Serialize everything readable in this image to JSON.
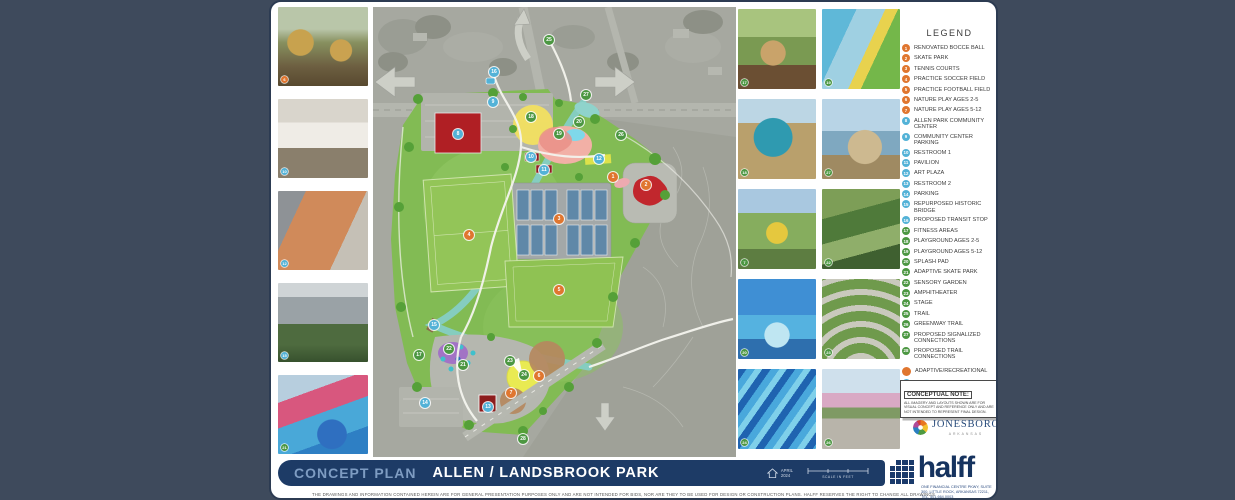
{
  "colors": {
    "orange": "#e0762f",
    "blue": "#53b2d7",
    "green": "#4c9742",
    "navy": "#1d3b66"
  },
  "legend": {
    "title": "LEGEND",
    "items": [
      {
        "n": 1,
        "c": "orange",
        "label": "RENOVATED BOCCE BALL"
      },
      {
        "n": 2,
        "c": "orange",
        "label": "SKATE PARK"
      },
      {
        "n": 3,
        "c": "orange",
        "label": "TENNIS COURTS"
      },
      {
        "n": 4,
        "c": "orange",
        "label": "PRACTICE SOCCER FIELD"
      },
      {
        "n": 5,
        "c": "orange",
        "label": "PRACTICE FOOTBALL FIELD"
      },
      {
        "n": 6,
        "c": "orange",
        "label": "NATURE PLAY AGES 2-5"
      },
      {
        "n": 7,
        "c": "orange",
        "label": "NATURE PLAY AGES 5-12"
      },
      {
        "n": 8,
        "c": "blue",
        "label": "ALLEN PARK COMMUNITY CENTER"
      },
      {
        "n": 9,
        "c": "blue",
        "label": "COMMUNITY CENTER PARKING"
      },
      {
        "n": 10,
        "c": "blue",
        "label": "RESTROOM 1"
      },
      {
        "n": 11,
        "c": "blue",
        "label": "PAVILION"
      },
      {
        "n": 12,
        "c": "blue",
        "label": "ART PLAZA"
      },
      {
        "n": 13,
        "c": "blue",
        "label": "RESTROOM 2"
      },
      {
        "n": 14,
        "c": "blue",
        "label": "PARKING"
      },
      {
        "n": 15,
        "c": "blue",
        "label": "REPURPOSED HISTORIC BRIDGE"
      },
      {
        "n": 16,
        "c": "blue",
        "label": "PROPOSED TRANSIT STOP"
      },
      {
        "n": 17,
        "c": "green",
        "label": "FITNESS AREAS"
      },
      {
        "n": 18,
        "c": "green",
        "label": "PLAYGROUND AGES 2-5"
      },
      {
        "n": 19,
        "c": "green",
        "label": "PLAYGROUND AGES 5-12"
      },
      {
        "n": 20,
        "c": "green",
        "label": "SPLASH PAD"
      },
      {
        "n": 21,
        "c": "green",
        "label": "ADAPTIVE SKATE PARK"
      },
      {
        "n": 22,
        "c": "green",
        "label": "SENSORY GARDEN"
      },
      {
        "n": 23,
        "c": "green",
        "label": "AMPHITHEATER"
      },
      {
        "n": 24,
        "c": "green",
        "label": "STAGE"
      },
      {
        "n": 25,
        "c": "green",
        "label": "TRAIL"
      },
      {
        "n": 26,
        "c": "green",
        "label": "GREENWAY TRAIL"
      },
      {
        "n": 27,
        "c": "green",
        "label": "PROPOSED SIGNALIZED CONNECTIONS"
      },
      {
        "n": 28,
        "c": "green",
        "label": "PROPOSED TRAIL CONNECTIONS"
      }
    ],
    "key": [
      {
        "c": "orange",
        "label": "ADAPTIVE/RECREATIONAL"
      },
      {
        "c": "blue",
        "label": "ACCESSIBLE/FACILITY"
      },
      {
        "c": "green",
        "label": "BOTH"
      }
    ]
  },
  "map": {
    "street": "RACE ST",
    "markers": [
      {
        "n": 1,
        "c": "orange",
        "x": 240,
        "y": 170
      },
      {
        "n": 2,
        "c": "orange",
        "x": 273,
        "y": 178
      },
      {
        "n": 3,
        "c": "orange",
        "x": 186,
        "y": 212
      },
      {
        "n": 4,
        "c": "orange",
        "x": 96,
        "y": 228
      },
      {
        "n": 5,
        "c": "orange",
        "x": 186,
        "y": 283
      },
      {
        "n": 6,
        "c": "orange",
        "x": 166,
        "y": 369
      },
      {
        "n": 7,
        "c": "orange",
        "x": 138,
        "y": 386
      },
      {
        "n": 8,
        "c": "blue",
        "x": 85,
        "y": 127
      },
      {
        "n": 9,
        "c": "blue",
        "x": 120,
        "y": 95
      },
      {
        "n": 10,
        "c": "blue",
        "x": 158,
        "y": 150
      },
      {
        "n": 11,
        "c": "blue",
        "x": 171,
        "y": 163
      },
      {
        "n": 12,
        "c": "blue",
        "x": 226,
        "y": 152
      },
      {
        "n": 13,
        "c": "blue",
        "x": 115,
        "y": 400
      },
      {
        "n": 14,
        "c": "blue",
        "x": 52,
        "y": 396
      },
      {
        "n": 15,
        "c": "blue",
        "x": 61,
        "y": 318
      },
      {
        "n": 16,
        "c": "blue",
        "x": 121,
        "y": 65
      },
      {
        "n": 17,
        "c": "green",
        "x": 46,
        "y": 348
      },
      {
        "n": 18,
        "c": "green",
        "x": 158,
        "y": 110
      },
      {
        "n": 19,
        "c": "green",
        "x": 186,
        "y": 127
      },
      {
        "n": 20,
        "c": "green",
        "x": 206,
        "y": 115
      },
      {
        "n": 21,
        "c": "green",
        "x": 90,
        "y": 358
      },
      {
        "n": 22,
        "c": "green",
        "x": 76,
        "y": 342
      },
      {
        "n": 23,
        "c": "green",
        "x": 137,
        "y": 354
      },
      {
        "n": 24,
        "c": "green",
        "x": 151,
        "y": 368
      },
      {
        "n": 25,
        "c": "green",
        "x": 176,
        "y": 33
      },
      {
        "n": 26,
        "c": "green",
        "x": 248,
        "y": 128
      },
      {
        "n": 27,
        "c": "green",
        "x": 213,
        "y": 88
      },
      {
        "n": 28,
        "c": "green",
        "x": 150,
        "y": 432
      }
    ]
  },
  "photos": {
    "left": [
      {
        "kind": "wood",
        "n": 6,
        "c": "orange"
      },
      {
        "kind": "restroom",
        "n": 10,
        "c": "blue"
      },
      {
        "kind": "plaza",
        "n": 12,
        "c": "blue"
      },
      {
        "kind": "bridge",
        "n": 15,
        "c": "blue"
      },
      {
        "kind": "skate",
        "n": 21,
        "c": "green"
      }
    ],
    "right": [
      {
        "kind": "spinner",
        "n": 17,
        "c": "green"
      },
      {
        "kind": "slide",
        "n": 19,
        "c": "green"
      },
      {
        "kind": "globe",
        "n": 18,
        "c": "green"
      },
      {
        "kind": "sandtable",
        "n": 27,
        "c": "green"
      },
      {
        "kind": "swing",
        "n": 7,
        "c": "green"
      },
      {
        "kind": "garden",
        "n": 22,
        "c": "green"
      },
      {
        "kind": "splashpad",
        "n": 20,
        "c": "green"
      },
      {
        "kind": "amphi",
        "n": 23,
        "c": "green"
      },
      {
        "kind": "waves",
        "n": 24,
        "c": "green"
      },
      {
        "kind": "blossom",
        "n": 26,
        "c": "green"
      }
    ]
  },
  "note": {
    "title": "CONCEPTUAL NOTE:",
    "body": "ALL IMAGERY AND LAYOUTS SHOWN ARE FOR VISUAL CONCEPT AND REFERENCE ONLY AND ARE NOT INTENDED TO REPRESENT FINAL DESIGN."
  },
  "jonesboro": {
    "name": "JONESBORO",
    "sub": "ARKANSAS"
  },
  "titlebar": {
    "label": "CONCEPT PLAN",
    "title": "ALLEN / LANDSBROOK PARK",
    "date_line1": "APRIL",
    "date_line2": "2024",
    "scale_label": "SCALE IN FEET"
  },
  "halff": {
    "name": "halff",
    "address": "ONE FINANCIAL CENTRE PKWY, SUITE 300, LITTLE ROCK, ARKANSAS 72211, TEL. 501.664.0003"
  },
  "disclaimer": "THE DRAWINGS AND INFORMATION CONTAINED HEREIN ARE FOR GENERAL PRESENTATION PURPOSES ONLY AND ARE NOT INTENDED FOR BIDS, NOR ARE THEY TO BE USED FOR DESIGN OR CONSTRUCTION PLANS. HALFF RESERVES THE RIGHT TO CHANGE ALL DRAWINGS AND INFORMATION AT ANY TIME WITHOUT NOTICE."
}
